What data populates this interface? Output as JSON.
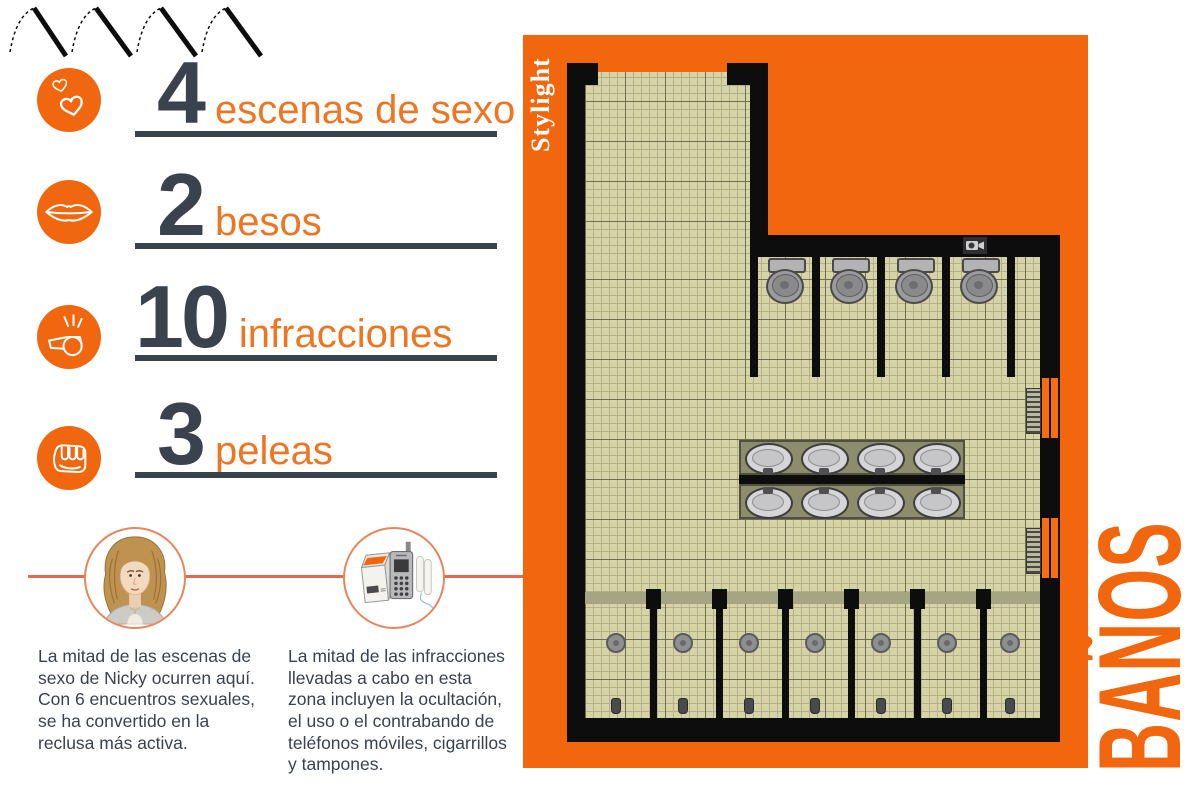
{
  "colors": {
    "panel_orange": "#f2670e",
    "label_orange": "#ee7623",
    "dark_slate": "#3a424d",
    "divider_red": "#e8684e",
    "floor_tile": "#d6d3a7",
    "wall_black": "#0d0d0d",
    "counter_olive": "#8d8d6d"
  },
  "stats": [
    {
      "icon": "hearts-icon",
      "value": "4",
      "label": "escenas de sexo"
    },
    {
      "icon": "lips-icon",
      "value": "2",
      "label": "besos"
    },
    {
      "icon": "whistle-icon",
      "value": "10",
      "label": "infracciones"
    },
    {
      "icon": "fist-icon",
      "value": "3",
      "label": "peleas"
    }
  ],
  "notes": [
    {
      "icon": "nicky-avatar",
      "text": "La mitad de las escenas de\nsexo de Nicky ocurren aquí.\nCon 6 encuentros sexuales,\nse ha convertido en la\nreclusa más activa."
    },
    {
      "icon": "contraband-illustration",
      "text": "La mitad de las infracciones\nllevadas a cabo en esta\nzona incluyen la ocultación,\nel uso o el contrabando de\nteléfonos móviles, cigarrillos\ny tampones."
    }
  ],
  "panel": {
    "brand": "Stylight",
    "title": "BAÑOS"
  },
  "floorplan": {
    "toilets": 4,
    "sinks": 8,
    "showers": 7,
    "radiators": 2,
    "cameras": 1
  }
}
